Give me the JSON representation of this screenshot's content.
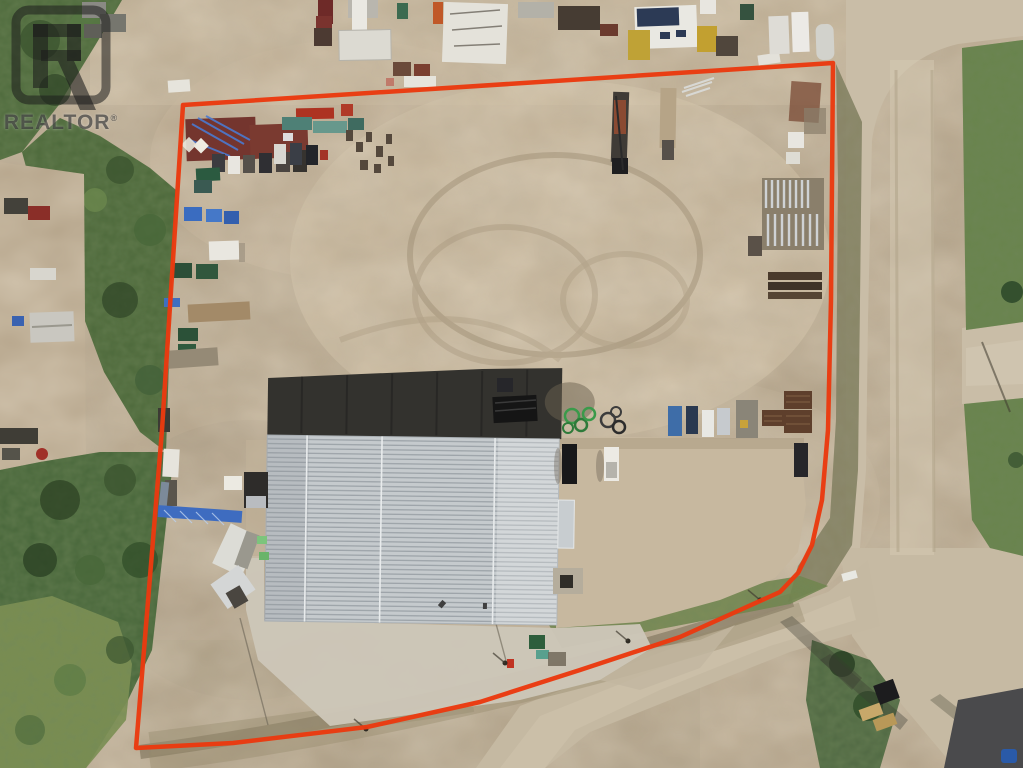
{
  "photo": {
    "description": "Aerial drone photo of an industrial yard property for sale: large corrugated-metal-roof shop building, dirt equipment yard with stored machinery, trailers and pipe racks, gravel roads on the right and bottom, tree line on the left, with the lot outlined in red and a REALTOR watermark in the top-left corner."
  },
  "watermark": {
    "label": "REALTOR",
    "registered_mark": "®"
  },
  "colors": {
    "boundary_red": "#ea3a10",
    "dirt_base": "#b2a187",
    "dirt_light": "#cfbfa3",
    "dirt_dark": "#9d8d72",
    "vegetation_dark": "#3c5530",
    "vegetation_light": "#7f9152",
    "road_gravel": "#c9bda7",
    "roof_metal": "#c5cacd",
    "roof_shadow_side": "#33322e",
    "concrete_pad": "#ccc6b8",
    "asphalt_pad": "#4a4a4c",
    "watermark_tint": "rgba(28,28,28,0.58)"
  }
}
